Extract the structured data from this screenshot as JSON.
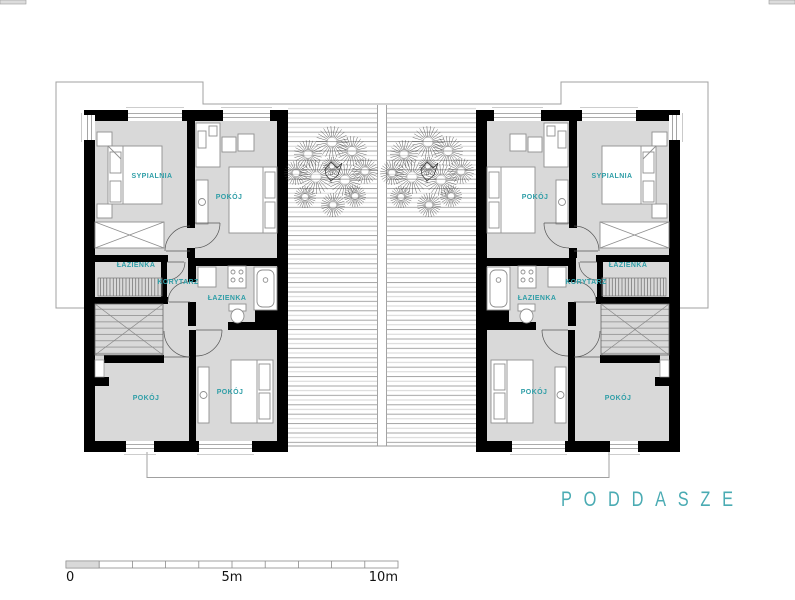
{
  "floor_label": "P O D D A S Z E",
  "floor_label_plain": "PODDASZE",
  "rooms": {
    "bedroom": "SYPIALNIA",
    "room": "POKÓJ",
    "bathroom": "ŁAZIENKA",
    "corridor": "KORYTARZ"
  },
  "scale_bar": {
    "zero": "0",
    "five": "5m",
    "ten": "10m",
    "segments": 10
  },
  "colors": {
    "label": "#2f9ea7",
    "title": "#4aabb3",
    "wall": "#000000",
    "floor": "#d9d9d9"
  }
}
